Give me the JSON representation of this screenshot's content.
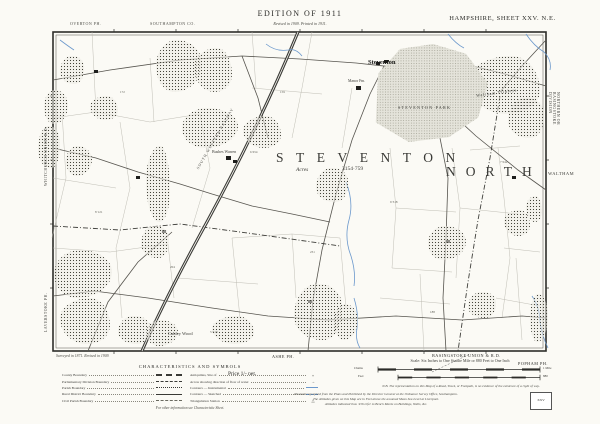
{
  "colors": {
    "paper": "#fbfaf5",
    "ink": "#2b2b28",
    "water": "#6b98cc",
    "park_fill": "#e4e3da"
  },
  "header": {
    "parish_top_left": "OVERTON PH.",
    "county_top": "SOUTHAMPTON CO.",
    "edition_title": "EDITION OF 1911",
    "edition_subtitle": "Revised in 1909. Printed in 1911.",
    "sheet_title": "HAMPSHIRE, SHEET XXV. N.E."
  },
  "margins": {
    "left_top": "WHITCHURCH UNION R.D.",
    "left_bottom": "LAVERSTOKE PH.",
    "right_vertical": "NORTHERN OR BASINGSTOKE DIVISION",
    "right_waltham": "WALTHAM",
    "bottom_ashe": "ASHE PH.",
    "bottom_union": "BASINGSTOKE UNION & R.D.",
    "bottom_popham": "POPHAM PH.",
    "survey_note": "Surveyed in 1871. Revised in 1909."
  },
  "map": {
    "parish_big": "STEVENTON",
    "acres_label": "Acres",
    "acres_value": "3154·759",
    "north_big": "NORTH",
    "village": "Steventon",
    "park": "STEVENTON PARK",
    "railway": "SOUTH WESTERN RAILWAY",
    "woods": {
      "cubley": "Cubley Wood",
      "trinleys": "Waltham Trinleys"
    },
    "farms": {
      "bushes": "Bushes Warren",
      "manor": "Manor Fm."
    },
    "parcels": [
      "172",
      "8·121",
      "204",
      "6·654",
      "231",
      "9·318",
      "188",
      "7·042",
      "159",
      "5·210"
    ]
  },
  "legend": {
    "title": "CHARACTERISTICS AND SYMBOLS",
    "left_rows": [
      "County Boundary",
      "Parliamentary Division Boundary",
      "Parish Boundary",
      "Rural District Boundary",
      "Civil Parish Boundary"
    ],
    "right_rows": [
      "Antiquities, Site of",
      "Arrow showing direction of flow of water",
      "Contours — Instrumental",
      "Contours — Sketched",
      "Triangulation Station"
    ],
    "symbols": {
      "antiquity": "+",
      "arrow": "→",
      "triangulation": "△"
    },
    "footer": "For other information see Characteristic Sheet."
  },
  "footer": {
    "price": "Price 1/- net.",
    "scale_title": "Scale: Six Inches to One Statute Mile or 880 Feet to One Inch",
    "scale_bar1_left": "Chains",
    "scale_bar1_right": "1 Mile",
    "scale_bar2_left": "Feet",
    "scale_bar2_right": "880",
    "nb_note": "N.B. The representation on this Map of a Road, Track, or Footpath, is no evidence of the existence of a right of way.",
    "imprint": [
      "Photozincographed from the Plans and Published by the Director General at the Ordnance Survey Office, Southampton.",
      "The Altitudes given on this Map are in Feet above the assumed Mean Sea Level at Liverpool.",
      "Altitudes indicated thus ·456 refer to Bench Marks on Buildings, Walls, &c."
    ],
    "index_label": "XXV"
  }
}
